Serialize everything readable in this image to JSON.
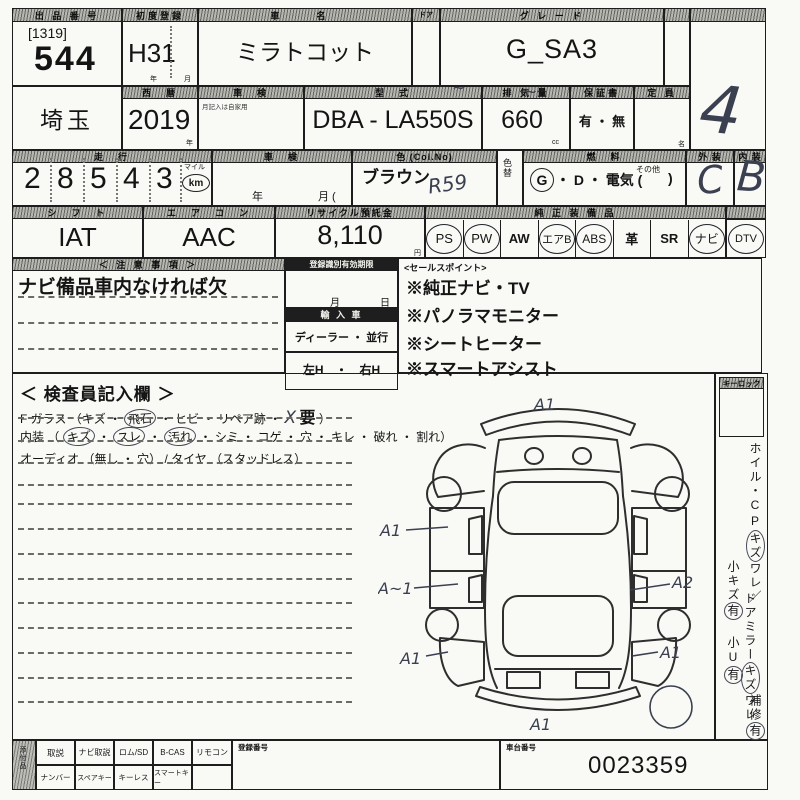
{
  "top": {
    "lot": {
      "header": "出 品 番 号",
      "bracket": "[1319]",
      "number": "544"
    },
    "first_reg": {
      "header": "初度登録",
      "value": "H31",
      "unit_year": "年",
      "unit_month": "月"
    },
    "car_name": {
      "header": "車　名",
      "value": "ミラトコット"
    },
    "door": {
      "header": "ドア"
    },
    "grade": {
      "header": "グ レ ー ド",
      "value": "G_SA3"
    },
    "score": {
      "value": "4"
    },
    "region": {
      "value": "埼玉"
    },
    "year": {
      "header": "西　暦",
      "value": "2019",
      "unit": "年"
    },
    "shaken": {
      "header": "車　検",
      "note": "月記入は自家用"
    },
    "model": {
      "header": "型　式",
      "value": "DBA - LA550S"
    },
    "displacement": {
      "header": "排 気 量",
      "value": "660",
      "unit": "cc"
    },
    "warranty": {
      "header": "保証書",
      "value": "有 ・ 無"
    },
    "capacity": {
      "header": "定 員",
      "unit": "名"
    },
    "mileage": {
      "header": "走　行",
      "digits": [
        "2",
        "8",
        "5",
        "4",
        "3"
      ],
      "unit_top": "マイル",
      "unit": "km"
    },
    "shaken_expiry": {
      "header": "車　検",
      "year_label": "年",
      "month_label": "月 ("
    },
    "color": {
      "header": "色 (Col.No)",
      "value": "ブラウン",
      "hand_code": "R59"
    },
    "color_change": {
      "header": "色替"
    },
    "fuel": {
      "header": "燃　料",
      "g": "G",
      "rest": "・ D ・ 電気 (",
      "other": "その他",
      "close": ")"
    },
    "exterior": {
      "header": "外 装",
      "value": "C"
    },
    "interior": {
      "header": "内 装",
      "value": "B"
    },
    "shift": {
      "header": "シ　フ　ト",
      "value": "IAT"
    },
    "aircon": {
      "header": "エ　ア　コ　ン",
      "value": "AAC"
    },
    "recycle": {
      "header": "リサイクル預託金",
      "value": "8,110",
      "unit": "円"
    },
    "equipment_header": "純 正 装 備 品",
    "equipment": [
      {
        "label": "PS",
        "circled": true
      },
      {
        "label": "PW",
        "circled": true
      },
      {
        "label": "AW",
        "circled": false
      },
      {
        "label": "エアB",
        "circled": true
      },
      {
        "label": "ABS",
        "circled": true
      },
      {
        "label": "革",
        "circled": false
      },
      {
        "label": "SR",
        "circled": false
      },
      {
        "label": "ナビ",
        "circled": true
      },
      {
        "label": "DTV",
        "circled": true
      }
    ]
  },
  "notes": {
    "header": "＜ 注 意 事 項 ＞",
    "line1": "ナビ備品車内なければ欠"
  },
  "registration": {
    "header": "登録識別有効期限",
    "month": "月",
    "day": "日",
    "import_header": "輸 入 車",
    "dealer": "ディーラー ・ 並行",
    "handle": "左H　・　右H"
  },
  "sales_points": {
    "header": "<セールスポイント>",
    "items": [
      "※純正ナビ・TV",
      "※パノラマモニター",
      "※シートヒーター",
      "※スマートアシスト"
    ]
  },
  "inspector": {
    "title": "＜ 検査員記入欄 ＞",
    "glass_p1": "F ガラス （キズ ・",
    "glass_circled": "飛石",
    "glass_p2": "・ ヒビ ・ リペア跡 ・",
    "glass_hand": "X",
    "glass_req": "要",
    "glass_p3": "）",
    "int_p1": "内装 （",
    "int_c1": "キズ",
    "int_d1": "・",
    "int_c2": "スレ",
    "int_d2": "・",
    "int_c3": "汚れ",
    "int_p2": "・ シミ ・ コゲ ・ 穴 ・ キレ ・ 破れ ・ 割れ）",
    "audio": "オーディオ （無し ・ 穴） / タイヤ （スタッドレス）"
  },
  "right_panel": {
    "keylock_header": "キーロック",
    "v1a": "ホイル・CP",
    "v1b": "キズ",
    "v1c": "ワレ／",
    "v2a": "ドアミラー",
    "v2b": "キズ",
    "v2c": "ワレ",
    "v3a": "小キズ",
    "v3b": "有",
    "v4a": "小U",
    "v4b": "有",
    "v5a": "補修",
    "v5b": "有"
  },
  "diagram": {
    "marks": [
      "A1",
      "A1",
      "A~1",
      "A2",
      "A1",
      "A1",
      "A1"
    ]
  },
  "bottom": {
    "attach_label": "添付品",
    "row1": [
      "取説",
      "ナビ取説",
      "ロム/SD",
      "B-CAS",
      "リモコン"
    ],
    "row2": [
      "ナンバー",
      "スペアキー",
      "キーレス",
      "スマートキー",
      ""
    ],
    "reg_header": "登録番号",
    "chassis_header": "車台番号",
    "chassis_no": "0023359"
  }
}
